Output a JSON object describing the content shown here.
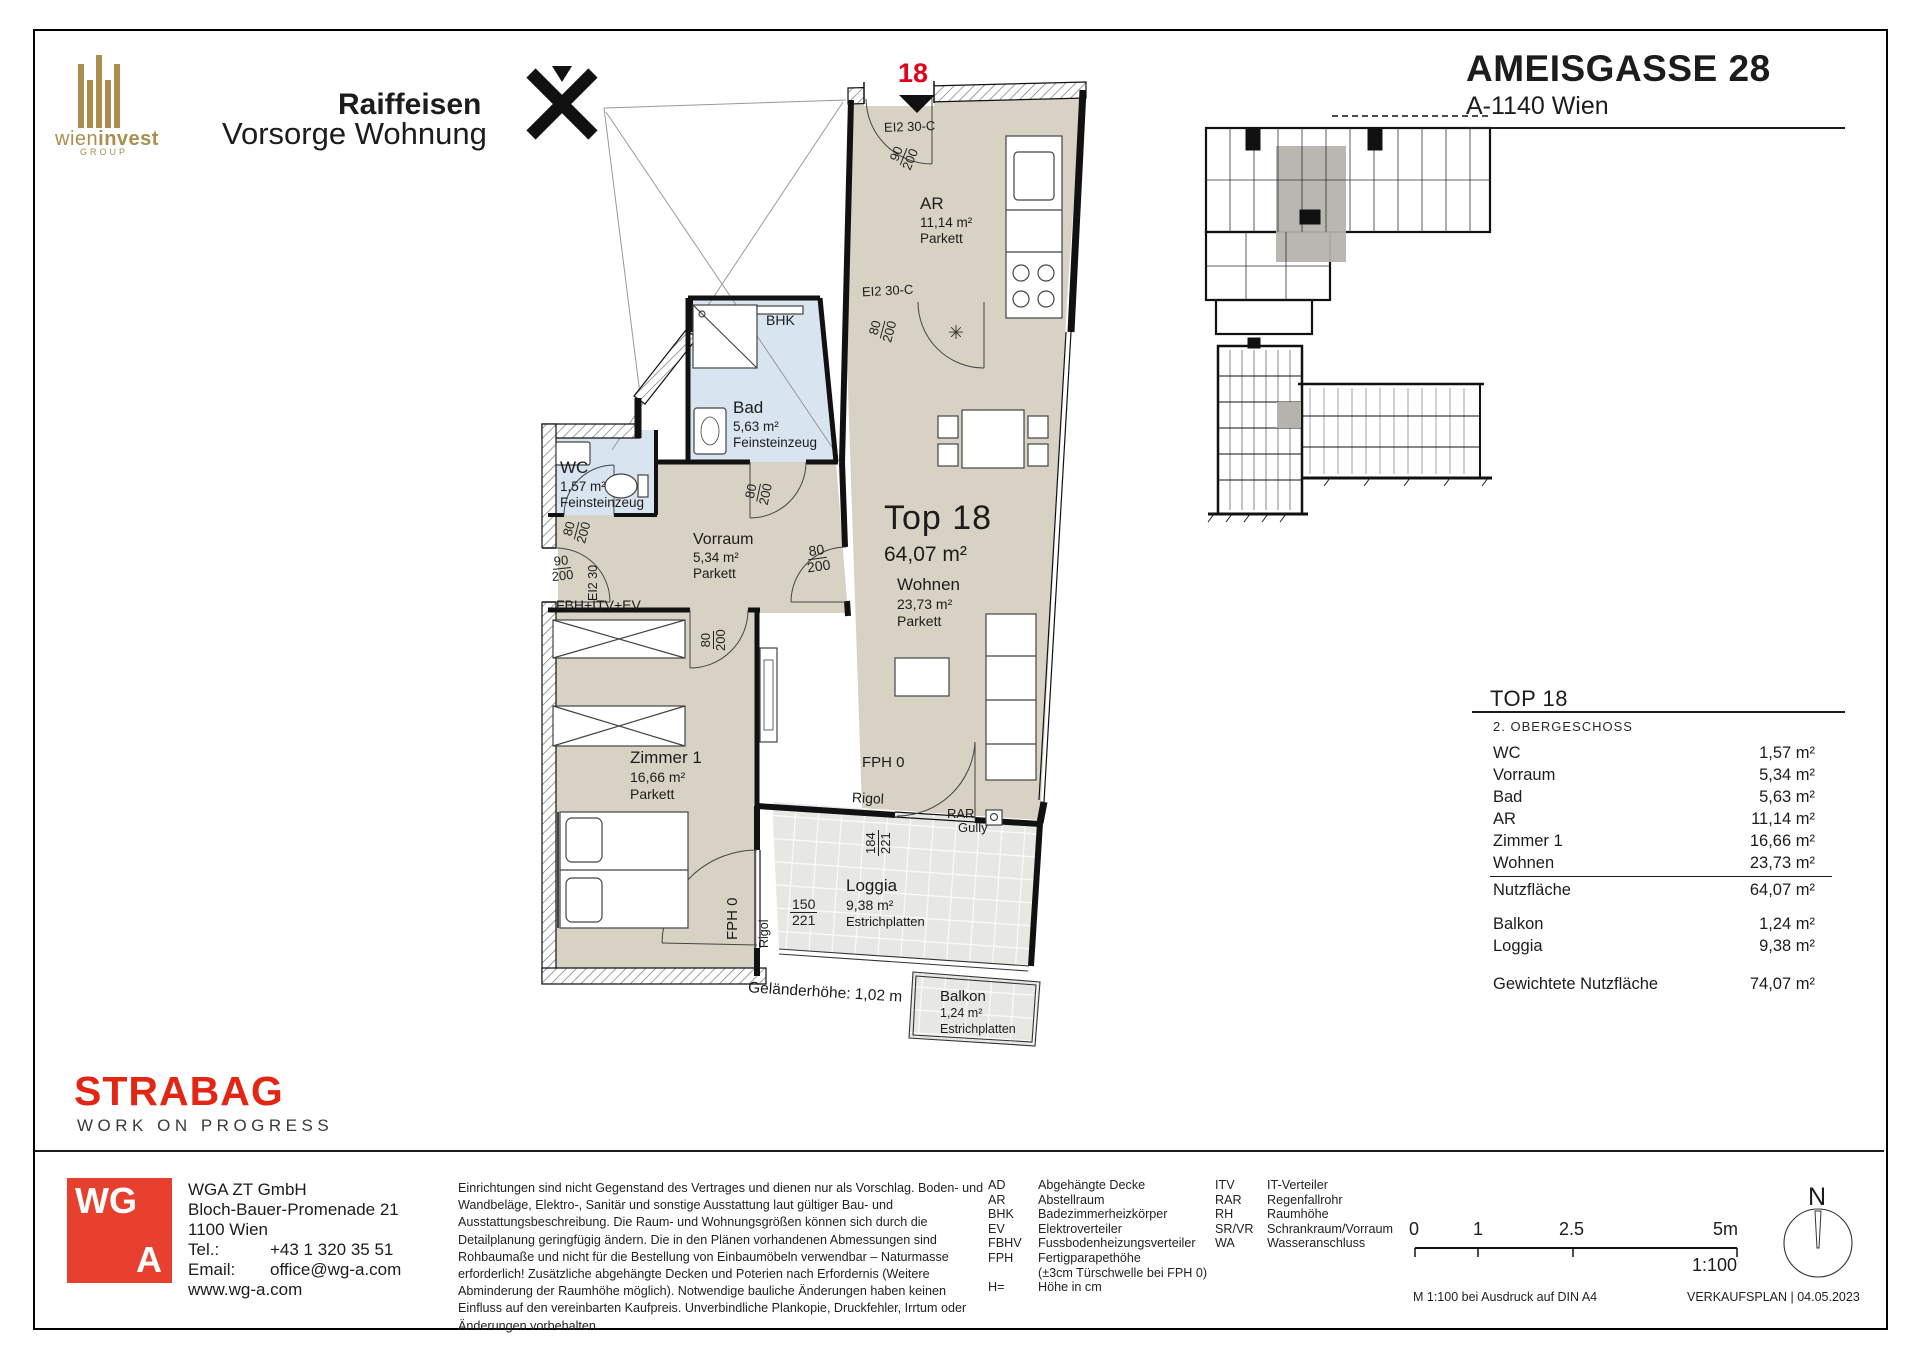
{
  "header": {
    "wieninvest_name_a": "wien",
    "wieninvest_name_b": "invest",
    "wieninvest_group": "GROUP",
    "raiffeisen_line1": "Raiffeisen",
    "raiffeisen_line2": "Vorsorge Wohnung",
    "project_title": "AMEISGASSE 28",
    "project_subtitle": "A-1140 Wien"
  },
  "plan": {
    "unit_marker": "18",
    "top_label": "Top 18",
    "top_area": "64,07 m²",
    "rooms": {
      "ar": {
        "name": "AR",
        "area": "11,14 m²",
        "floor": "Parkett"
      },
      "bad": {
        "name": "Bad",
        "area": "5,63 m²",
        "floor": "Feinsteinzeug"
      },
      "wc": {
        "name": "WC",
        "area": "1,57 m²",
        "floor": "Feinsteinzeug"
      },
      "vorraum": {
        "name": "Vorraum",
        "area": "5,34 m²",
        "floor": "Parkett"
      },
      "zimmer1": {
        "name": "Zimmer 1",
        "area": "16,66 m²",
        "floor": "Parkett"
      },
      "wohnen": {
        "name": "Wohnen",
        "area": "23,73 m²",
        "floor": "Parkett"
      },
      "loggia": {
        "name": "Loggia",
        "area": "9,38 m²",
        "floor": "Estrichplatten"
      },
      "balkon": {
        "name": "Balkon",
        "area": "1,24 m²",
        "floor": "Estrichplatten"
      }
    },
    "ann": {
      "door_entry_top": "EI2 30-C",
      "door_ar": "EI2 30-C",
      "door_entry_side": "EI2 30",
      "bhk": "BHK",
      "fbh": "FBH+ITV+EV",
      "fph0": "FPH 0",
      "rigol": "Rigol",
      "rar": "RAR",
      "gully": "Gully",
      "railing_note": "Geländerhöhe: 1,02 m",
      "sink_symbol": "✳",
      "d90": "90",
      "d80": "80",
      "d200": "200",
      "d184": "184",
      "d150": "150",
      "d221": "221"
    }
  },
  "summary": {
    "title": "TOP 18",
    "floor": "2. OBERGESCHOSS",
    "rows": [
      {
        "label": "WC",
        "value": "1,57 m²"
      },
      {
        "label": "Vorraum",
        "value": "5,34 m²"
      },
      {
        "label": "Bad",
        "value": "5,63 m²"
      },
      {
        "label": "AR",
        "value": "11,14 m²"
      },
      {
        "label": "Zimmer 1",
        "value": "16,66 m²"
      },
      {
        "label": "Wohnen",
        "value": "23,73 m²"
      }
    ],
    "subtotal": {
      "label": "Nutzfläche",
      "value": "64,07 m²"
    },
    "extras": [
      {
        "label": "Balkon",
        "value": "1,24 m²"
      },
      {
        "label": "Loggia",
        "value": "9,38 m²"
      }
    ],
    "total": {
      "label": "Gewichtete Nutzfläche",
      "value": "74,07 m²"
    }
  },
  "strabag": {
    "name": "STRABAG",
    "tagline": "WORK ON PROGRESS"
  },
  "architect": {
    "logo_top": "WG",
    "logo_bottom": "A",
    "company": "WGA ZT GmbH",
    "address": "Bloch-Bauer-Promenade 21",
    "city": "1100 Wien",
    "tel_label": "Tel.:",
    "tel": "+43 1 320 35 51",
    "email_label": "Email:",
    "email": "office@wg-a.com",
    "web": "www.wg-a.com"
  },
  "disclaimer": "Einrichtungen sind nicht Gegenstand des Vertrages und dienen nur als Vorschlag. Boden- und Wandbeläge, Elektro-, Sanitär und sonstige Ausstattung laut gültiger Bau- und Ausstattungsbeschreibung. Die Raum- und Wohnungsgrößen können sich durch die Detailplanung geringfügig ändern. Die in den Plänen vorhandenen Abmessungen sind Rohbaumaße und nicht für die Bestellung von Einbaumöbeln verwendbar – Naturmasse erforderlich! Zusätzliche abgehängte Decken und Poterien nach Erfordernis (Weitere Abminderung der Raumhöhe möglich). Notwendige bauliche Änderungen haben keinen Einfluss auf den vereinbarten Kaufpreis. Unverbindliche Plankopie, Druckfehler, Irrtum oder Änderungen vorbehalten.",
  "legend": {
    "col1": [
      {
        "abbr": "AD",
        "desc": "Abgehängte Decke"
      },
      {
        "abbr": "AR",
        "desc": "Abstellraum"
      },
      {
        "abbr": "BHK",
        "desc": "Badezimmerheizkörper"
      },
      {
        "abbr": "EV",
        "desc": "Elektroverteiler"
      },
      {
        "abbr": "FBHV",
        "desc": "Fussbodenheizungsverteiler"
      },
      {
        "abbr": "FPH",
        "desc": "Fertigparapethöhe",
        "desc2": "(±3cm Türschwelle bei FPH 0)"
      },
      {
        "abbr": "H=",
        "desc": "Höhe in cm"
      }
    ],
    "col2": [
      {
        "abbr": "ITV",
        "desc": "IT-Verteiler"
      },
      {
        "abbr": "RAR",
        "desc": "Regenfallrohr"
      },
      {
        "abbr": "RH",
        "desc": "Raumhöhe"
      },
      {
        "abbr": "SR/VR",
        "desc": "Schrankraum/Vorraum"
      },
      {
        "abbr": "WA",
        "desc": "Wasseranschluss"
      }
    ]
  },
  "footer": {
    "scale_ticks": [
      "0",
      "1",
      "2.5",
      "5m"
    ],
    "scale_ratio": "1:100",
    "print_note": "M 1:100 bei Ausdruck auf DIN A4",
    "plan_type": "VERKAUFSPLAN | 04.05.2023",
    "north": "N"
  },
  "colors": {
    "accent_red": "#e2001a",
    "strabag_red": "#e22613",
    "wga_red": "#e8402f",
    "gold": "#a98e4e",
    "raiffeisen_yellow": "#ffe500",
    "room_beige": "#d7d2c3",
    "wet_blue": "#d8e4f0",
    "tile_gray": "#e7e7e4",
    "highlight_gray": "#b5b3ae"
  }
}
